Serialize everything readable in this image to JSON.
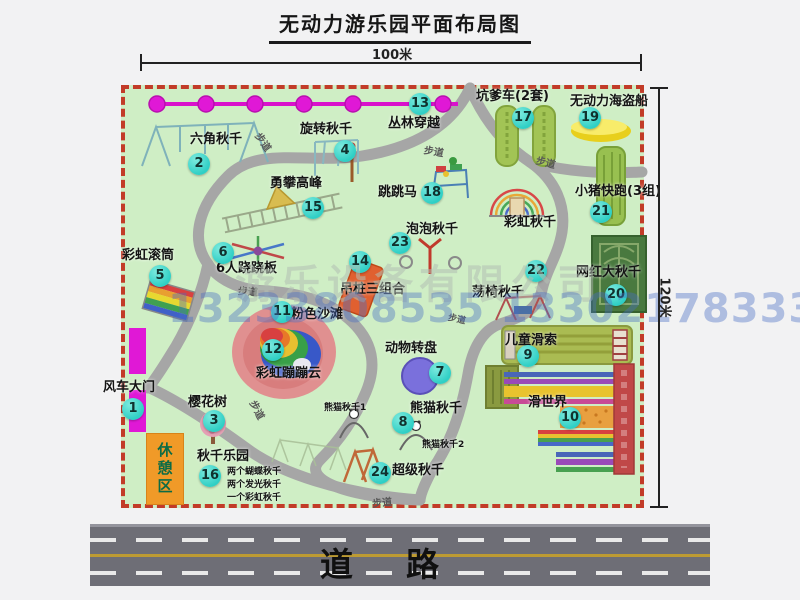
{
  "title": "无动力游乐园平面布局图",
  "dimensions": {
    "width_label": "100米",
    "height_label": "120米"
  },
  "road": {
    "label": "道　路"
  },
  "watermark": {
    "company": "游乐设备有限公司",
    "phones": "13233808535 13302178333"
  },
  "path_label": "步道",
  "rest_area_label": "休憩区",
  "extra": {
    "rainbow_swing": "彩虹秋千",
    "panda1": "熊猫秋千1",
    "panda2": "熊猫秋千2",
    "swing_sub1": "两个蝴蝶秋千",
    "swing_sub2": "两个发光秋千",
    "swing_sub3": "一个彩虹秋千"
  },
  "pois": [
    {
      "num": "1",
      "label": "风车大门"
    },
    {
      "num": "2",
      "label": "六角秋千"
    },
    {
      "num": "3",
      "label": "樱花树"
    },
    {
      "num": "4",
      "label": "旋转秋千"
    },
    {
      "num": "5",
      "label": "彩虹滚筒"
    },
    {
      "num": "6",
      "label": "6人跷跷板"
    },
    {
      "num": "7",
      "label": "动物转盘"
    },
    {
      "num": "8",
      "label": "熊猫秋千"
    },
    {
      "num": "9",
      "label": "儿童滑索"
    },
    {
      "num": "10",
      "label": "滑世界"
    },
    {
      "num": "11",
      "label": "粉色沙滩"
    },
    {
      "num": "12",
      "label": "彩虹蹦蹦云"
    },
    {
      "num": "13",
      "label": "丛林穿越"
    },
    {
      "num": "14",
      "label": "吊桩三组合"
    },
    {
      "num": "15",
      "label": "勇攀高峰"
    },
    {
      "num": "16",
      "label": "秋千乐园"
    },
    {
      "num": "17",
      "label": "坑爹车(2套)"
    },
    {
      "num": "18",
      "label": "跳跳马"
    },
    {
      "num": "19",
      "label": "无动力海盗船"
    },
    {
      "num": "20",
      "label": "网红大秋千"
    },
    {
      "num": "21",
      "label": "小猪快跑(3组)"
    },
    {
      "num": "22",
      "label": "荡椅秋千"
    },
    {
      "num": "23",
      "label": "泡泡秋千"
    },
    {
      "num": "24",
      "label": "超级秋千"
    }
  ],
  "colors": {
    "park-green": "#cfeec5",
    "border-red": "#c23b28",
    "badge-cyan": "#2fcfc5",
    "chain-magenta": "#e018d6",
    "road-gray": "#6e6e76",
    "rest-orange": "#f09a28"
  }
}
